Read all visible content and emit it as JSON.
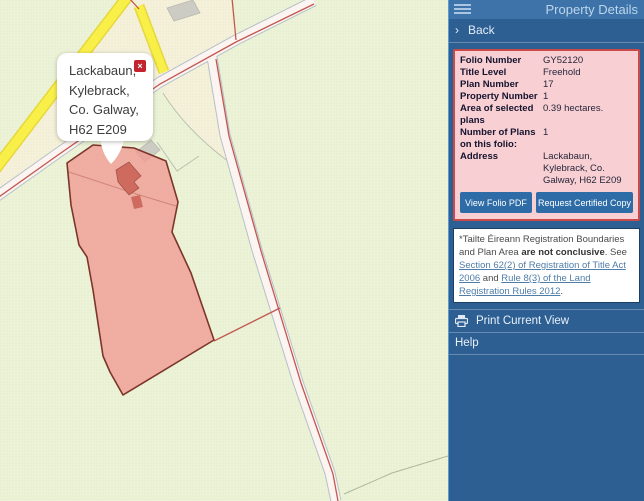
{
  "colors": {
    "sidebar_bg": "#2d5f93",
    "sidebar_header_bg": "#3d73a8",
    "panel_bg": "#f8cfd3",
    "panel_border": "#ca4a4a",
    "button_bg": "#2d6ca6",
    "map_bg": "#edf3d8",
    "parcel_fill": "#f29a8e",
    "parcel_border": "#7c352a",
    "road_yellow": "#f9ef49",
    "boundary_red": "#c2574f",
    "popup_close_bg": "#c2232e",
    "link": "#4f7da9"
  },
  "map": {
    "popup": {
      "address_full": "Lackabaun, Kylebrack, Co. Galway, H62 E209",
      "line1": "Lackabaun,",
      "line2": "Kylebrack,",
      "line3": "Co. Galway,",
      "line4": "H62 E209",
      "close_glyph": "×"
    }
  },
  "sidebar": {
    "header": {
      "title": "Property Details",
      "menu_icon": "hamburger-menu-icon"
    },
    "back": {
      "chevron": "›",
      "label": "Back"
    },
    "folio": {
      "rows": [
        {
          "label": "Folio Number",
          "value": "GY52120"
        },
        {
          "label": "Title Level",
          "value": "Freehold"
        },
        {
          "label": "Plan Number",
          "value": "17"
        },
        {
          "label": "Property Number",
          "value": "1"
        },
        {
          "label": "Area of selected plans",
          "value": "0.39 hectares."
        },
        {
          "label": "Number of Plans on this folio:",
          "value": "1"
        },
        {
          "label": "Address",
          "value": "Lackabaun, Kylebrack, Co. Galway, H62 E209"
        }
      ],
      "buttons": [
        {
          "label": "View Folio PDF"
        },
        {
          "label": "Request Certified Copy"
        }
      ]
    },
    "disclaimer": {
      "prefix": "*Tailte Éireann Registration Boundaries and Plan Area ",
      "bold": "are not conclusive",
      "mid": ". See ",
      "link1": "Section 62(2) of Registration of Title Act 2006",
      "joiner": " and ",
      "link2": "Rule 8(3) of the Land Registration Rules 2012",
      "suffix": "."
    },
    "print": {
      "label": "Print Current View",
      "icon": "printer-icon"
    },
    "help": {
      "label": "Help"
    }
  }
}
